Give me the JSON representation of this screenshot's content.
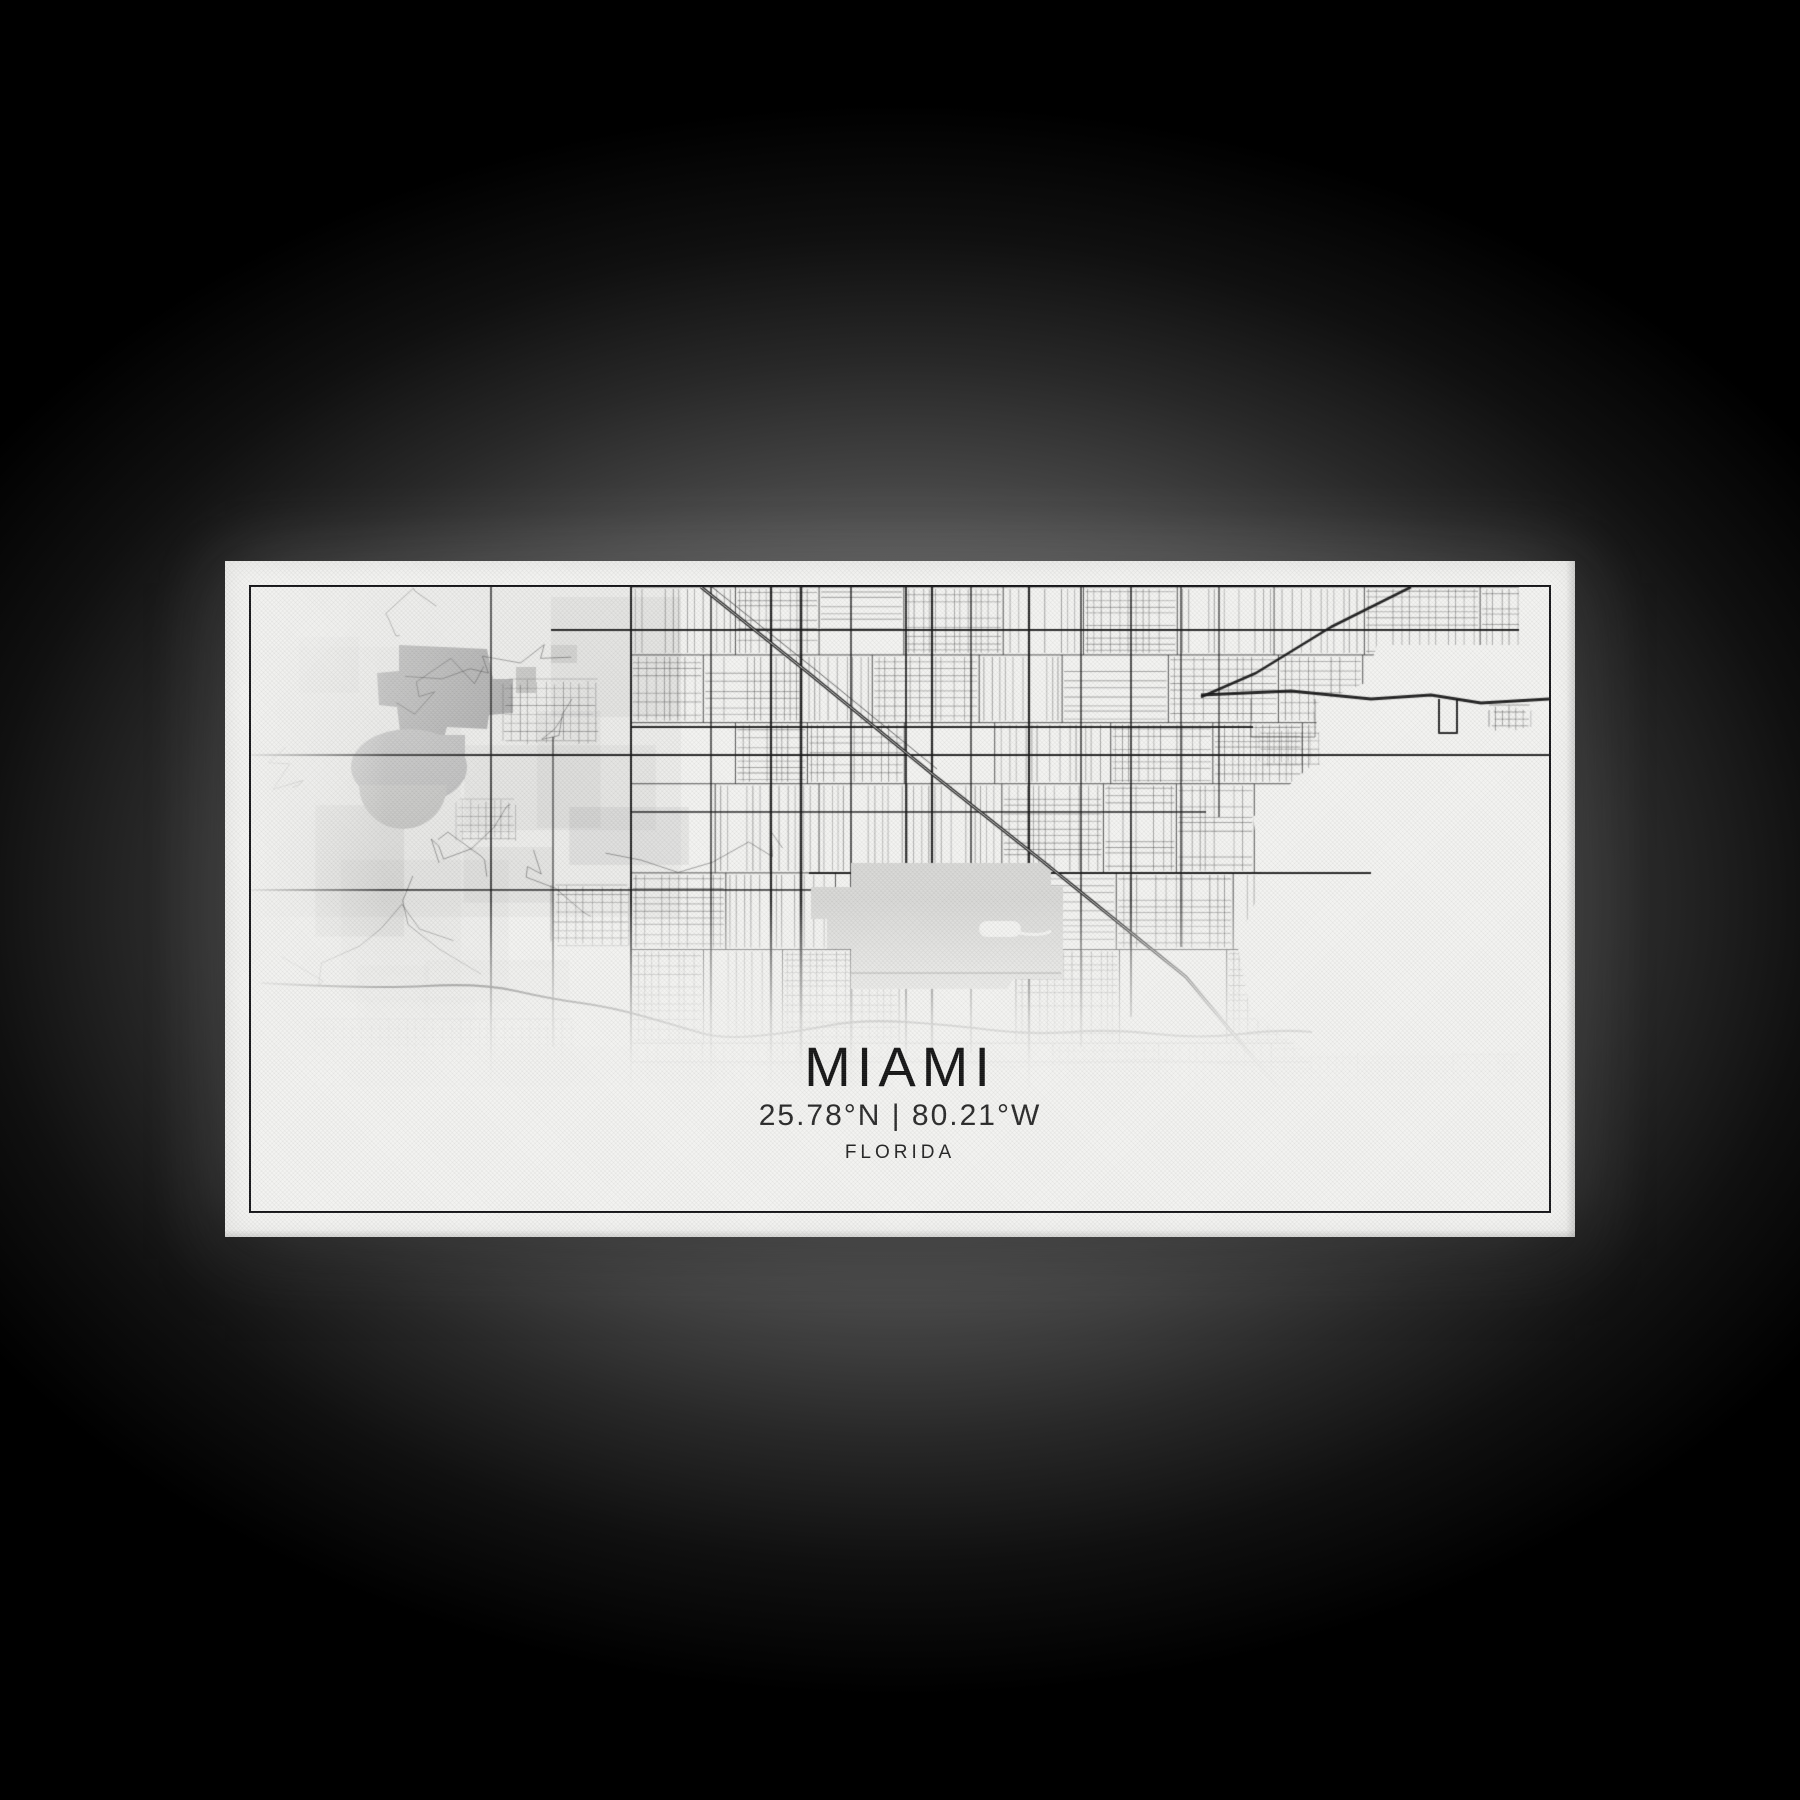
{
  "artwork": {
    "title": "MIAMI",
    "coordinates": "25.78°N | 80.21°W",
    "region": "FLORIDA"
  },
  "colors": {
    "paper": "#f3f3f1",
    "ink": "#1a1a1a",
    "water": "#aeaeae",
    "water_light": "#bdbdbd",
    "airport": "#d8d8d6",
    "border": "#17171a",
    "background": "#000000"
  }
}
